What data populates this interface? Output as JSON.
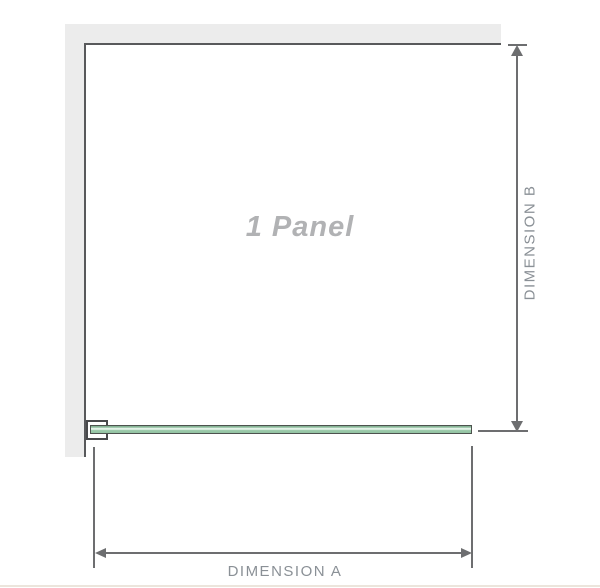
{
  "diagram": {
    "panel_label": "1 Panel",
    "dimension_a_label": "DIMENSION A",
    "dimension_b_label": "DIMENSION B"
  },
  "colors": {
    "wall_fill": "#ececec",
    "wall_edge": "#58595b",
    "dimension_line": "#6d6e70",
    "dimension_text": "#8a9096",
    "panel_text": "#b1b2b4",
    "glass_outline": "#4d524e",
    "glass_green_dark": "#7fae90",
    "glass_green_mid": "#9ccaaa",
    "glass_green_light": "#e2f2e7",
    "clamp_outline": "#48494b",
    "footer_line": "#ece5dc"
  }
}
